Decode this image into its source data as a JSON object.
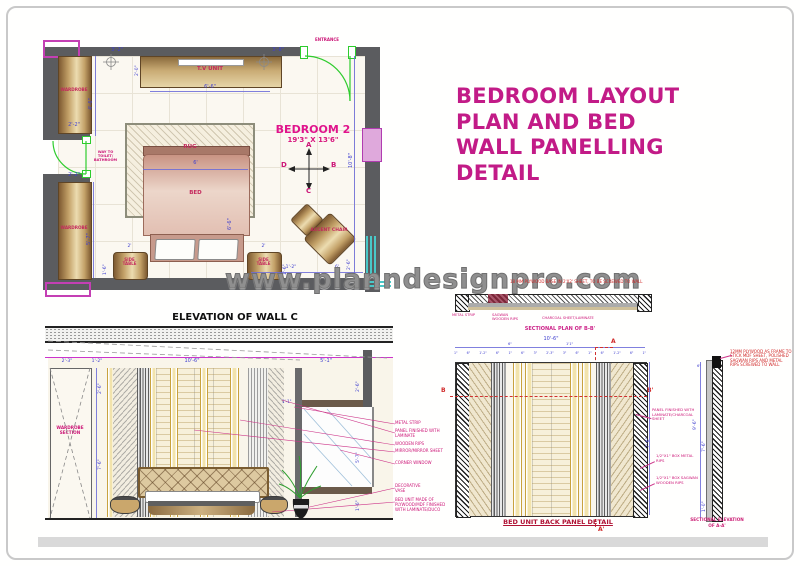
{
  "page": {
    "watermark": "www.planndesignpro.com"
  },
  "main_title": {
    "line1": "BEDROOM LAYOUT",
    "line2": "PLAN AND BED",
    "line3": "WALL PANELLING",
    "line4": "DETAIL"
  },
  "floor_plan": {
    "room_name": "BEDROOM 2",
    "room_size": "19'3\" X 13'6\"",
    "entrance_label": "ENTRANCE",
    "toilet_label": "WAY TO TOILET/ BATHROOM",
    "furniture": {
      "tv_unit": "T.V UNIT",
      "rug": "RUG",
      "bed": "BED",
      "wardrobe": "WARDROBE",
      "side_table": "SIDE TABLE",
      "accent_chair": "ACCENT CHAIR"
    },
    "compass": {
      "n": "A",
      "e": "B",
      "s": "C",
      "w": "D"
    },
    "dims": {
      "top_left": "3'-2\"",
      "top_left_v": "2'-0\"",
      "top_right": "3'-8\"",
      "tv_width": "6'-6\"",
      "wardrobe_top_w": "2'-2\"",
      "left_upper": "4'-6\"",
      "wardrobe_bot_w": "2'-2\"",
      "left_lower": "5'-7\"",
      "bed_w": "6'",
      "bed_l": "6'-6\"",
      "right_wall": "10'-8\"",
      "side_table_w": "2'",
      "side_table_d": "1'-6\"",
      "bottom_gap": "1'-2\"",
      "bottom_span": "6'",
      "bottom_right_v": "2'-6\""
    }
  },
  "elevation": {
    "title": "ELEVATION OF WALL C",
    "ceiling_label": "CEILING SECTION",
    "wardrobe_label": "WARDROBE SECTION",
    "dims": {
      "d1": "2'-3\"",
      "d2": "1'-2\"",
      "d3": "10'-6\"",
      "d4": "5'-1\"",
      "d5": "2'-6\"",
      "d6": "1'-1\"",
      "d7": "5'-7\"",
      "d8": "1'-6\"",
      "d9": "2'-6\"",
      "d10": "7'-6\""
    },
    "annotations": [
      "METAL STRIP",
      "PANEL FINISHED WITH LAMINATE",
      "WOODEN RIPS",
      "MIRROR/MIRROR SHEET",
      "CORNER WINDOW",
      "DECORATIVE VASE",
      "BED UNIT MADE OF PLYWOOD/MDF FINISHED WITH LAMINATE/DUCO"
    ]
  },
  "sectional_plan": {
    "note": "18 MM PLYWOOD BASE IN 2'X2' SHEET, TO BE SCREWED TO WALL",
    "labels": [
      "METAL STRIP",
      "SAGWAN WOODEN RIPS",
      "CHARCOAL SHEET/LAMINATE"
    ],
    "title": "SECTIONAL PLAN OF B-B'"
  },
  "back_panel": {
    "title": "BED UNIT BACK PANEL DETAIL",
    "overall_dim": "10'-6\"",
    "raised_dims": [
      "6\"",
      "1'1\""
    ],
    "top_dims": [
      "1\"",
      "6\"",
      "1'-2\"",
      "6\"",
      "1\"",
      "6\"",
      "3\"",
      "2'-3\"",
      "3\"",
      "6\"",
      "1\"",
      "6\"",
      "1'-2\"",
      "6\"",
      "1\""
    ],
    "height_dim": "7'-6\"",
    "markers": {
      "a": "A",
      "a_prime": "A'",
      "b": "B",
      "b_prime": "B'"
    }
  },
  "section_aa": {
    "title_line1": "SECTIONAL ELEVATION",
    "title_line2": "OF A-A'",
    "note": "12MM PLYWOOD AS FRAME TO STICK MDF SHEET, POLISHED SAGWAN RIPS AND METAL RIPS SCREWED TO WALL",
    "annotations": [
      "PANEL FINISHED WITH LAMINATE/CHARCOAL SHEET",
      "1/2\"X1\" BOX METAL RIPS",
      "1/2\"X1\" BOX SAGWAN WOODEN RIPS"
    ],
    "dims": {
      "full": "9'-6\"",
      "inner": "7'-6\"",
      "bottom": "1'-0\"",
      "top": "6\""
    }
  }
}
